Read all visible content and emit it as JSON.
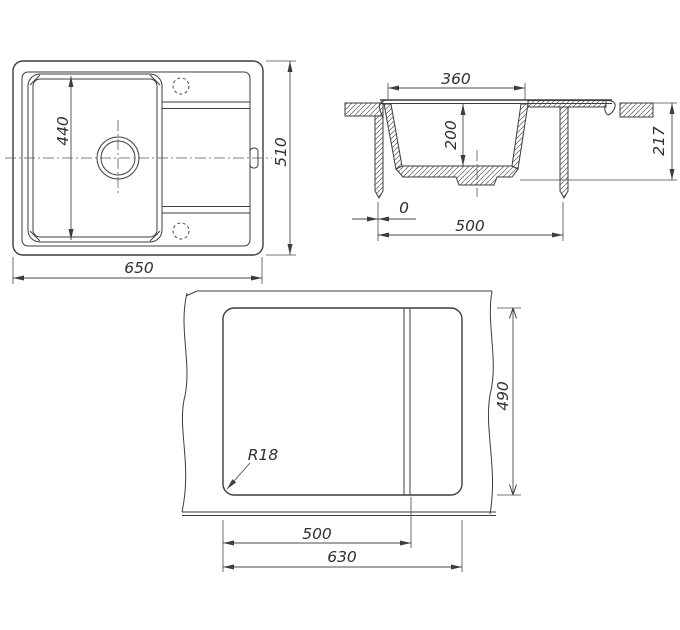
{
  "drawing": {
    "kind": "kitchen-sink installation drawing",
    "views": [
      "plan",
      "cross-section",
      "countertop-cutout-template"
    ]
  },
  "dims": {
    "plan": {
      "bowl_length": "440",
      "overall_depth": "510",
      "overall_width": "650"
    },
    "section": {
      "bowl_top_width": "360",
      "bowl_depth": "200",
      "total_height": "217",
      "edge_offset": "0",
      "cutout_span": "500"
    },
    "template": {
      "cutout_depth": "490",
      "bowl_zone_width": "500",
      "cutout_width": "630",
      "corner_radius": "R18"
    }
  },
  "colors": {
    "line": "#3d3d3d",
    "centerline": "#5a5a5a",
    "background": "#ffffff"
  }
}
